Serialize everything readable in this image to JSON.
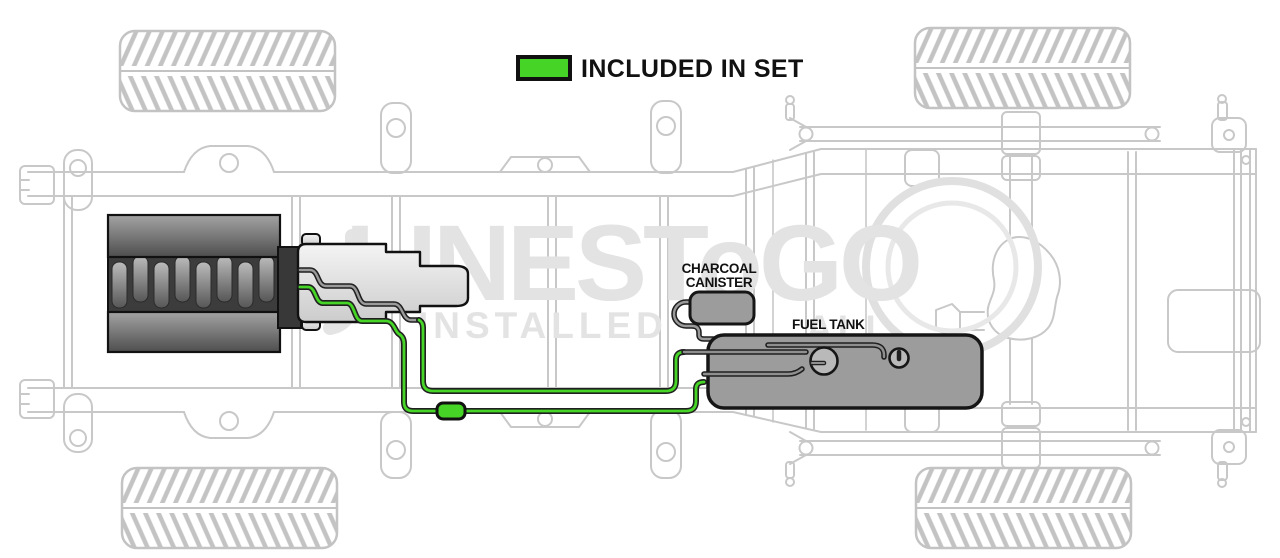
{
  "legend": {
    "label": "INCLUDED IN SET",
    "swatch_meaning": "green-swatch-icon"
  },
  "labels": {
    "charcoal_line1": "CHARCOAL",
    "charcoal_line2": "CANISTER",
    "fuel_tank": "FUEL TANK"
  },
  "watermark": {
    "brand": "LINESToGO",
    "word": "INSTALLED",
    "fragment": "ALL"
  },
  "colors": {
    "included_green": "#46d527",
    "part_gray": "#9c9c9c",
    "port_gray": "#b9b9b9",
    "frame_line": "#c8c8c8",
    "outline": "#161616",
    "watermark_gray": "#e3e3e3"
  },
  "diagram": {
    "view": "truck chassis underbody, top view",
    "highlighted_parts": [
      "fuel feed line",
      "fuel return line",
      "inline fuel filter"
    ],
    "gray_parts": [
      "charcoal canister",
      "fuel tank",
      "fuel pump port",
      "sender port",
      "engine",
      "transmission"
    ]
  }
}
